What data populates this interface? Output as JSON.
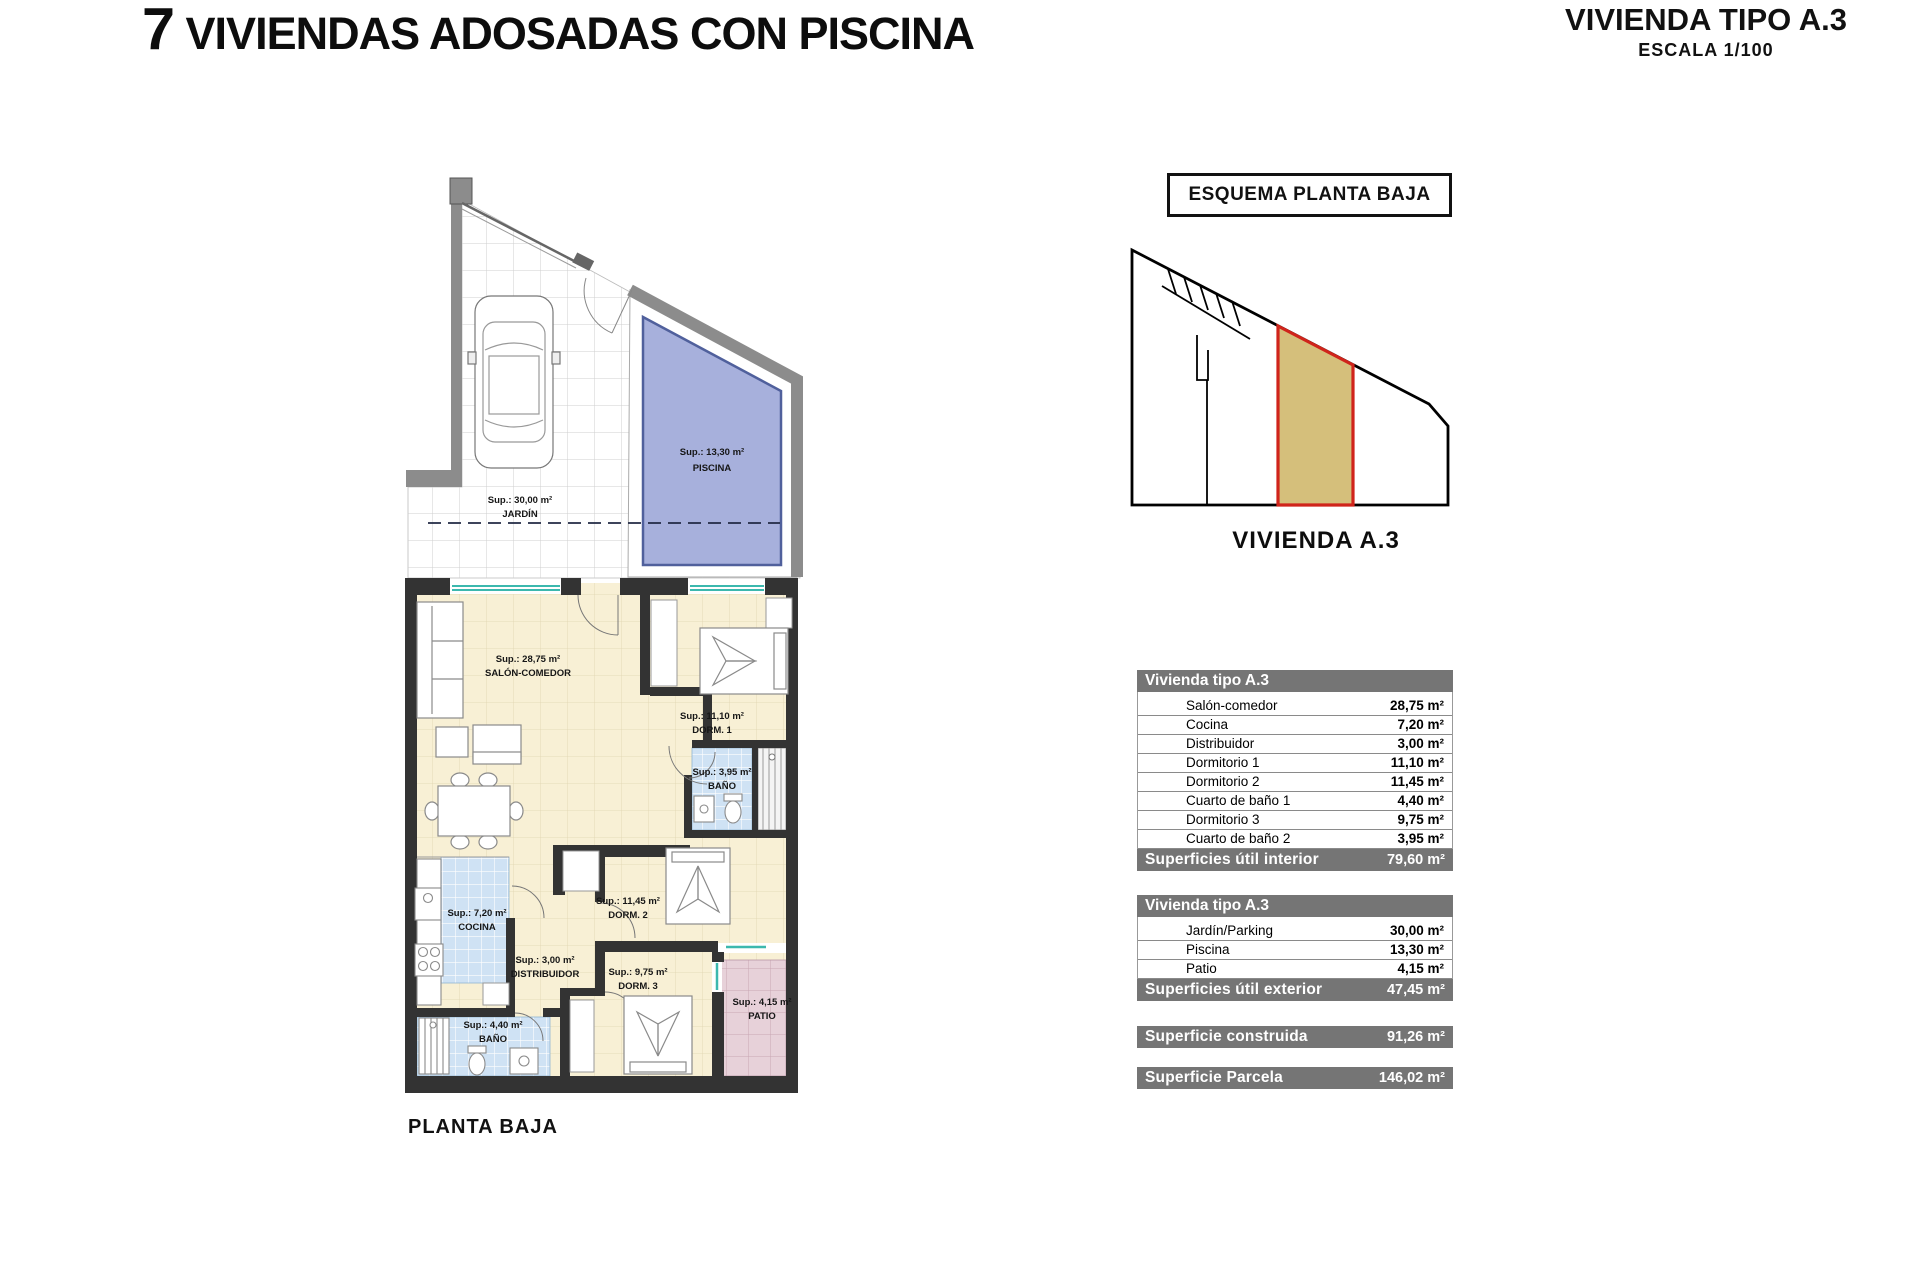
{
  "header": {
    "title": "7 VIVIENDAS ADOSADAS CON PISCINA",
    "type_title": "VIVIENDA TIPO A.3",
    "scale": "ESCALA 1/100"
  },
  "plan": {
    "caption": "PLANTA BAJA",
    "rooms": {
      "jardin": {
        "sup": "Sup.: 30,00 m²",
        "name": "JARDÍN"
      },
      "piscina": {
        "sup": "Sup.: 13,30 m²",
        "name": "PISCINA"
      },
      "salon": {
        "sup": "Sup.: 28,75 m²",
        "name": "SALÓN-COMEDOR"
      },
      "dorm1": {
        "sup": "Sup.: 11,10 m²",
        "name": "DORM. 1"
      },
      "bano1": {
        "sup": "Sup.: 3,95 m²",
        "name": "BAÑO"
      },
      "cocina": {
        "sup": "Sup.: 7,20 m²",
        "name": "COCINA"
      },
      "distribuidor": {
        "sup": "Sup.: 3,00 m²",
        "name": "DISTRIBUIDOR"
      },
      "dorm2": {
        "sup": "Sup.: 11,45 m²",
        "name": "DORM. 2"
      },
      "dorm3": {
        "sup": "Sup.: 9,75 m²",
        "name": "DORM. 3"
      },
      "bano2": {
        "sup": "Sup.: 4,40 m²",
        "name": "BAÑO"
      },
      "patio": {
        "sup": "Sup.: 4,15 m²",
        "name": "PATIO"
      }
    }
  },
  "schema": {
    "title": "ESQUEMA PLANTA BAJA",
    "label": "VIVIENDA A.3"
  },
  "tables": {
    "interior": {
      "header": "Vivienda tipo A.3",
      "rows": [
        {
          "label": "Salón-comedor",
          "value": "28,75 m²"
        },
        {
          "label": "Cocina",
          "value": "7,20 m²"
        },
        {
          "label": "Distribuidor",
          "value": "3,00 m²"
        },
        {
          "label": "Dormitorio 1",
          "value": "11,10 m²"
        },
        {
          "label": "Dormitorio 2",
          "value": "11,45 m²"
        },
        {
          "label": "Cuarto de baño 1",
          "value": "4,40 m²"
        },
        {
          "label": "Dormitorio 3",
          "value": "9,75 m²"
        },
        {
          "label": "Cuarto de baño 2",
          "value": "3,95 m²"
        }
      ],
      "footer": {
        "label": "Superficies útil interior",
        "value": "79,60 m²"
      }
    },
    "exterior": {
      "header": "Vivienda tipo A.3",
      "rows": [
        {
          "label": "Jardín/Parking",
          "value": "30,00 m²"
        },
        {
          "label": "Piscina",
          "value": "13,30 m²"
        },
        {
          "label": "Patio",
          "value": "4,15 m²"
        }
      ],
      "footer": {
        "label": "Superficies útil exterior",
        "value": "47,45 m²"
      }
    },
    "construida": {
      "label": "Superficie construida",
      "value": "91,26 m²"
    },
    "parcela": {
      "label": "Superficie Parcela",
      "value": "146,02 m²"
    }
  },
  "colors": {
    "wall_dark": "#333333",
    "wall_gray": "#8c8c8c",
    "pool_blue": "#a7b0dc",
    "floor_cream": "#f8f0d5",
    "tile_blue": "#cfe2f4",
    "tile_pink": "#e7d1d9",
    "window_teal": "#3cb8ae",
    "table_bar_gray": "#757575",
    "parcel_fill": "#d5bf7b",
    "parcel_stroke": "#d0241b"
  }
}
